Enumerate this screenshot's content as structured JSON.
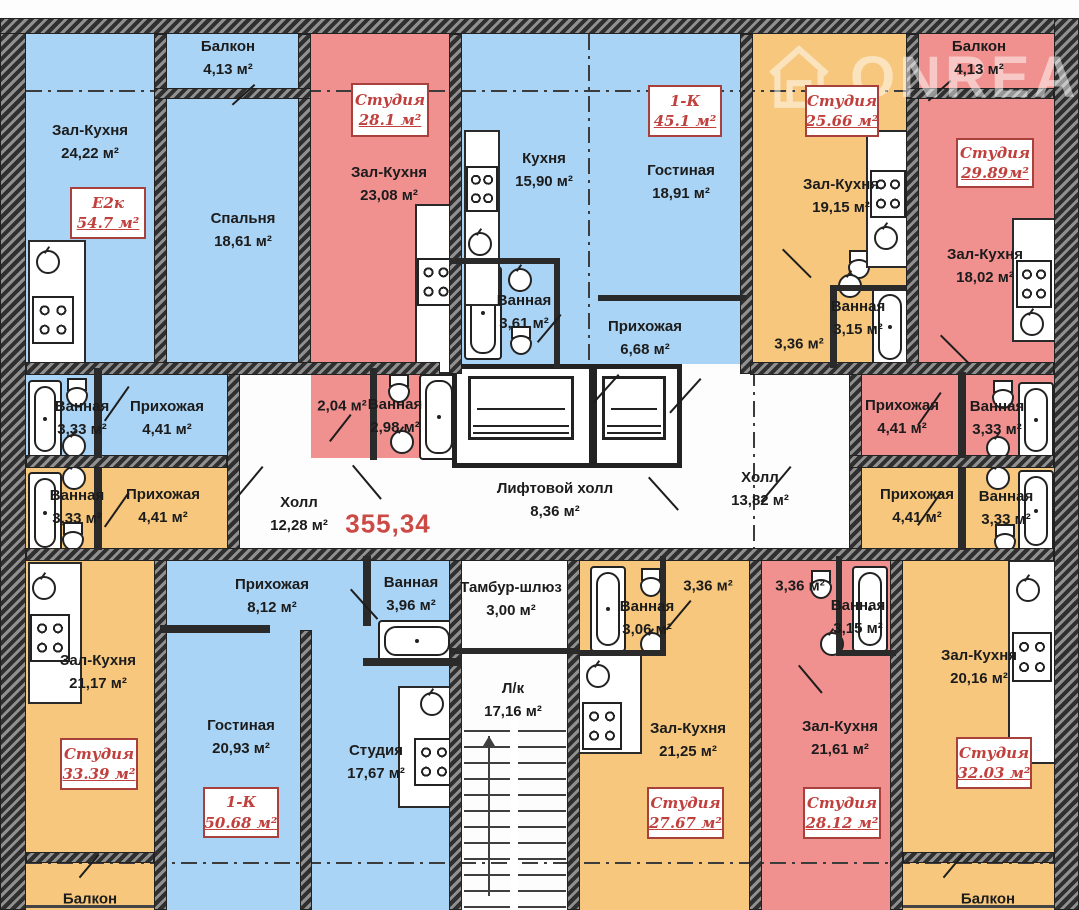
{
  "watermark": {
    "brand": "ONREAL"
  },
  "total_area": "355,34",
  "colors": {
    "apartment_blue": "#aad4f5",
    "apartment_red": "#f0908f",
    "apartment_orange": "#f6c77d",
    "corridor_white": "#ffffff",
    "wall_dark": "#2f2f2f",
    "badge_red": "#b8403c",
    "total_red": "#cc4a45"
  },
  "badges": [
    {
      "type": "Е2к",
      "area": "54.7 м²"
    },
    {
      "type": "Студия",
      "area": "28.1 м²"
    },
    {
      "type": "1-К",
      "area": "45.1 м²"
    },
    {
      "type": "Студия",
      "area": "25.66 м²"
    },
    {
      "type": "Студия",
      "area": "29.89м²"
    },
    {
      "type": "Студия",
      "area": "33.39 м²"
    },
    {
      "type": "1-К",
      "area": "50.68 м²"
    },
    {
      "type": "Студия",
      "area": "27.67 м²"
    },
    {
      "type": "Студия",
      "area": "28.12 м²"
    },
    {
      "type": "Студия",
      "area": "32.03 м²"
    }
  ],
  "labels": [
    {
      "name": "Зал-Кухня",
      "area": "24,22 м²"
    },
    {
      "name": "Балкон",
      "area": "4,13 м²"
    },
    {
      "name": "Спальня",
      "area": "18,61 м²"
    },
    {
      "name": "Зал-Кухня",
      "area": "23,08 м²"
    },
    {
      "name": "Кухня",
      "area": "15,90 м²"
    },
    {
      "name": "Гостиная",
      "area": "18,91 м²"
    },
    {
      "name": "Ванная",
      "area": "3,61 м²"
    },
    {
      "name": "Прихожая",
      "area": "6,68 м²"
    },
    {
      "name": "Зал-Кухня",
      "area": "19,15 м²"
    },
    {
      "name": "",
      "area": "3,36 м²"
    },
    {
      "name": "Ванная",
      "area": "3,15 м²"
    },
    {
      "name": "Балкон",
      "area": "4,13 м²"
    },
    {
      "name": "Зал-Кухня",
      "area": "18,02 м²"
    },
    {
      "name": "Ванная",
      "area": "3,33 м²"
    },
    {
      "name": "Прихожая",
      "area": "4,41 м²"
    },
    {
      "name": "",
      "area": "2,04 м²"
    },
    {
      "name": "Ванная",
      "area": "2,98 м²"
    },
    {
      "name": "Прихожая",
      "area": "4,41 м²"
    },
    {
      "name": "Ванная",
      "area": "3,33 м²"
    },
    {
      "name": "Холл",
      "area": "12,28 м²"
    },
    {
      "name": "Лифтовой холл",
      "area": "8,36 м²"
    },
    {
      "name": "Холл",
      "area": "13,82 м²"
    },
    {
      "name": "Ванная",
      "area": "3,33 м²"
    },
    {
      "name": "Прихожая",
      "area": "4,41 м²"
    },
    {
      "name": "Зал-Кухня",
      "area": "21,17 м²"
    },
    {
      "name": "Прихожая",
      "area": "8,12 м²"
    },
    {
      "name": "Ванная",
      "area": "3,96 м²"
    },
    {
      "name": "Гостиная",
      "area": "20,93 м²"
    },
    {
      "name": "Студия",
      "area": "17,67 м²"
    },
    {
      "name": "Тамбур-шлюз",
      "area": "3,00 м²"
    },
    {
      "name": "Л/к",
      "area": "17,16 м²"
    },
    {
      "name": "Ванная",
      "area": "3,06 м²"
    },
    {
      "name": "",
      "area": "3,36 м²"
    },
    {
      "name": "Зал-Кухня",
      "area": "21,25 м²"
    },
    {
      "name": "",
      "area": "3,36 м²"
    },
    {
      "name": "Ванная",
      "area": "3,15 м²"
    },
    {
      "name": "Зал-Кухня",
      "area": "21,61 м²"
    },
    {
      "name": "Прихожая",
      "area": "4,41 м²"
    },
    {
      "name": "Ванная",
      "area": "3,33 м²"
    },
    {
      "name": "Зал-Кухня",
      "area": "20,16 м²"
    },
    {
      "name": "Балкон",
      "area": ""
    },
    {
      "name": "Балкон",
      "area": ""
    }
  ]
}
